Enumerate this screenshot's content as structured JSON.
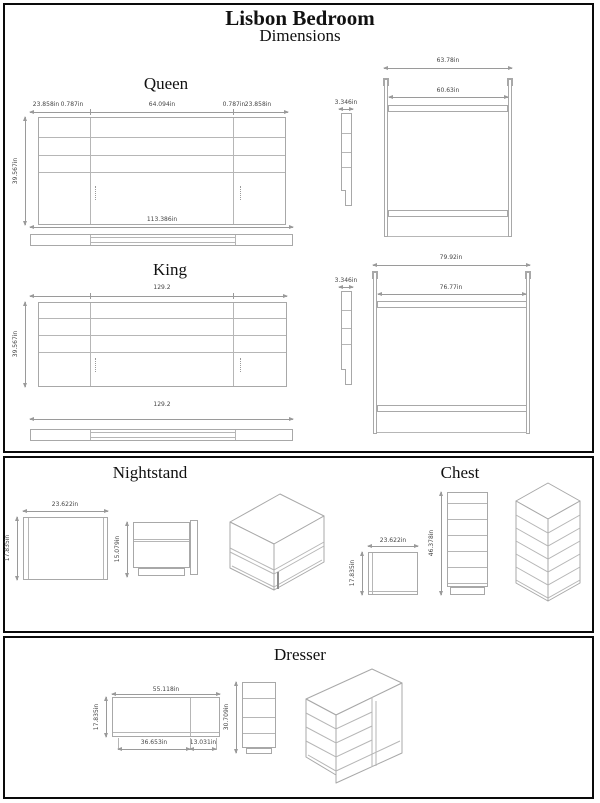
{
  "page": {
    "title": "Lisbon Bedroom",
    "subtitle": "Dimensions"
  },
  "colors": {
    "drawing_line": "#a8a8a8",
    "dimension_line": "#9a9a9a",
    "dimension_text": "#444444",
    "section_border": "#0a0a0a"
  },
  "queen": {
    "label": "Queen",
    "headboard": {
      "top_dims": [
        "23.858in",
        "0.787in",
        "64.094in",
        "0.787in",
        "23.858in"
      ],
      "height": "39.567in",
      "rail_width": "113.386in"
    },
    "side_profile": {
      "thickness": "3.346in"
    },
    "frame": {
      "outer_width": "63.78in",
      "inner_width": "60.63in"
    }
  },
  "king": {
    "label": "King",
    "headboard": {
      "width": "129.2",
      "height": "39.567in",
      "rail_width": "129.2"
    },
    "side_profile": {
      "thickness": "3.346in"
    },
    "frame": {
      "outer_width": "79.92in",
      "inner_width": "76.77in"
    }
  },
  "nightstand": {
    "label": "Nightstand",
    "front": {
      "width": "23.622in",
      "height": "17.835in"
    },
    "side": {
      "height": "15.079in"
    }
  },
  "chest": {
    "label": "Chest",
    "top": {
      "width": "23.622in",
      "depth": "17.835in"
    },
    "front": {
      "height": "46.378in"
    }
  },
  "dresser": {
    "label": "Dresser",
    "front": {
      "width": "55.118in",
      "height": "17.835in",
      "bottom_left": "36.653in",
      "bottom_right": "13.031in"
    },
    "side": {
      "height": "30.709in"
    }
  }
}
